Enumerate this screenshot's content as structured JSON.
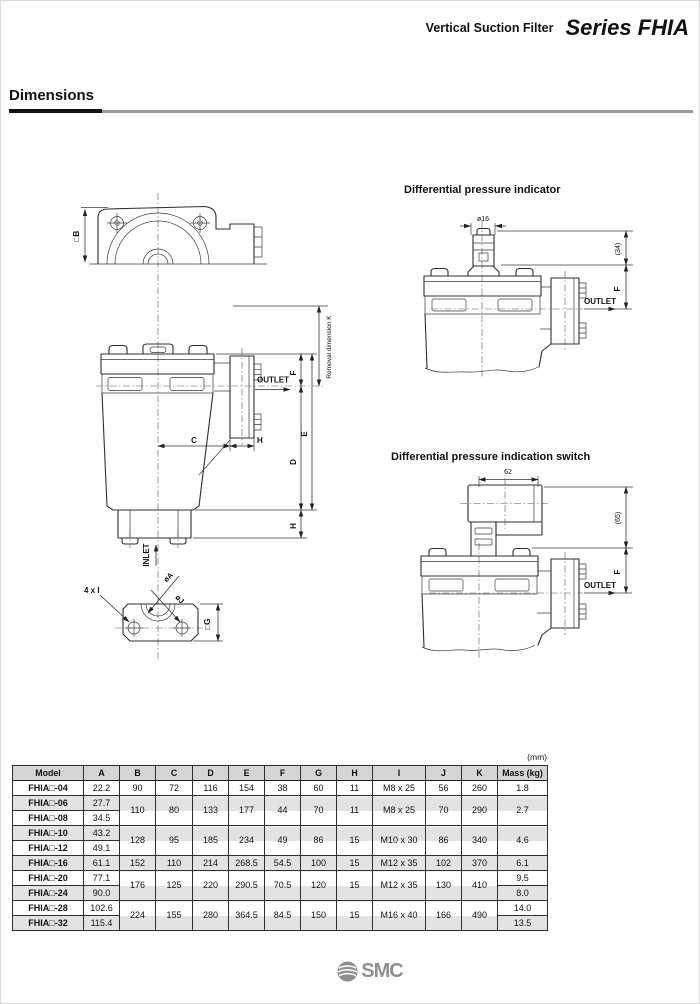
{
  "header": {
    "product": "Vertical Suction Filter",
    "series": "Series FHIA"
  },
  "section": {
    "title": "Dimensions"
  },
  "front_view": {
    "dim_b": "□B",
    "removal_k": "Removal dimension K",
    "dim_f": "F",
    "dim_e": "E",
    "dim_d": "D",
    "dim_c": "C",
    "dim_h_side": "H",
    "dim_h_bottom": "H",
    "outlet": "OUTLET",
    "inlet": "INLET"
  },
  "bottom_view": {
    "bolt_note": "4 x I",
    "dia_a": "øA",
    "dia_j": "øJ",
    "dim_g": "□G"
  },
  "indicator_view": {
    "title": "Differential pressure indicator",
    "dia_16": "ø16",
    "dim_34": "(34)",
    "dim_f": "F",
    "outlet": "OUTLET"
  },
  "switch_view": {
    "title": "Differential pressure indication switch",
    "dim_62": "62",
    "dim_65": "(65)",
    "dim_f": "F",
    "outlet": "OUTLET"
  },
  "table": {
    "unit": "(mm)",
    "headers": [
      "Model",
      "A",
      "B",
      "C",
      "D",
      "E",
      "F",
      "G",
      "H",
      "I",
      "J",
      "K",
      "Mass (kg)"
    ],
    "rows": {
      "r04": {
        "model": "FHIA□-04",
        "a": "22.2",
        "b": "90",
        "c": "72",
        "d": "116",
        "e": "154",
        "f": "38",
        "g": "60",
        "h": "11",
        "i": "M8 x 25",
        "j": "56",
        "k": "260",
        "mass": "1.8"
      },
      "r06": {
        "model": "FHIA□-06",
        "a": "27.7",
        "b": "110",
        "c": "80",
        "d": "133",
        "e": "177",
        "f": "44",
        "g": "70",
        "h": "11",
        "i": "M8 x 25",
        "j": "70",
        "k": "290",
        "mass": "2.7"
      },
      "r08": {
        "model": "FHIA□-08",
        "a": "34.5"
      },
      "r10": {
        "model": "FHIA□-10",
        "a": "43.2",
        "b": "128",
        "c": "95",
        "d": "185",
        "e": "234",
        "f": "49",
        "g": "86",
        "h": "15",
        "i": "M10 x 30",
        "j": "86",
        "k": "340",
        "mass": "4.6"
      },
      "r12": {
        "model": "FHIA□-12",
        "a": "49.1"
      },
      "r16": {
        "model": "FHIA□-16",
        "a": "61.1",
        "b": "152",
        "c": "110",
        "d": "214",
        "e": "268.5",
        "f": "54.5",
        "g": "100",
        "h": "15",
        "i": "M12 x 35",
        "j": "102",
        "k": "370",
        "mass": "6.1"
      },
      "r20": {
        "model": "FHIA□-20",
        "a": "77.1",
        "b": "176",
        "c": "125",
        "d": "220",
        "e": "290.5",
        "f": "70.5",
        "g": "120",
        "h": "15",
        "i": "M12 x 35",
        "j": "130",
        "k": "410",
        "mass": "9.5"
      },
      "r24": {
        "model": "FHIA□-24",
        "a": "90.0",
        "mass": "8.0"
      },
      "r28": {
        "model": "FHIA□-28",
        "a": "102.6",
        "b": "224",
        "c": "155",
        "d": "280",
        "e": "364.5",
        "f": "84.5",
        "g": "150",
        "h": "15",
        "i": "M16 x 40",
        "j": "166",
        "k": "490",
        "mass": "14.0"
      },
      "r32": {
        "model": "FHIA□-32",
        "a": "115.4",
        "mass": "13.5"
      }
    }
  },
  "footer": {
    "logo": "SMC"
  }
}
